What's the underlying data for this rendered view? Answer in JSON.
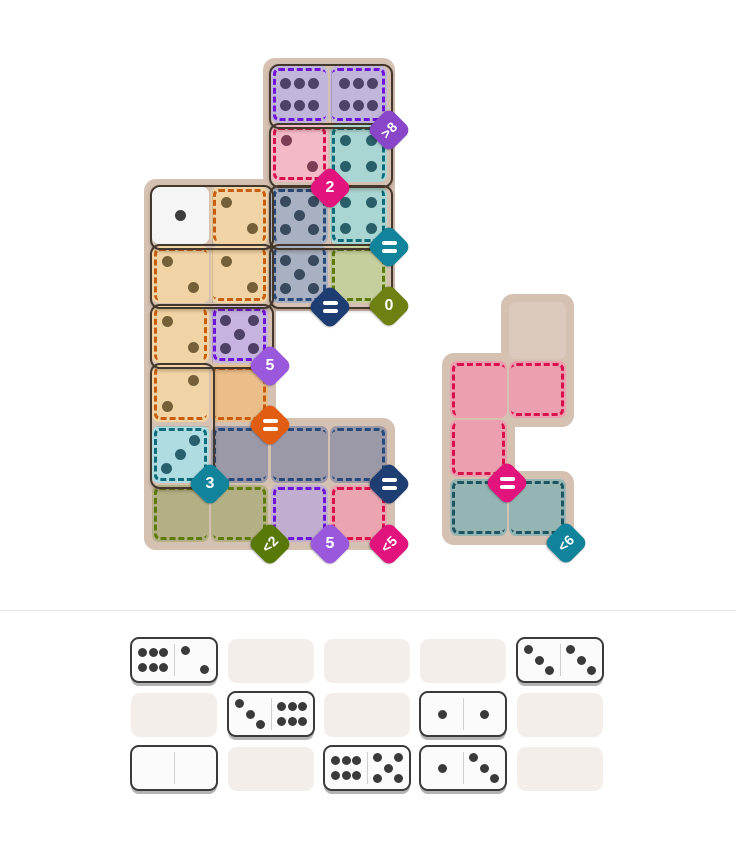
{
  "app": {
    "name": "domino-regions-puzzle"
  },
  "palette": {
    "page_bg": "#ffffff",
    "divider": "#e4e4e4",
    "backdrop": "#d5c1b2",
    "pair_outline": "#44372c",
    "tray_slot": "#f4eeea",
    "tray_tile_face": "#fbfbfb",
    "tray_tile_border": "#3a3a3a",
    "tray_tile_shadow": "#b3b3b3",
    "tray_pip": "#3a3a3a",
    "fills": {
      "purple_f": "#c1b5da",
      "pink_f": "#f3b9c7",
      "teal_f": "#a9d6d2",
      "slate_f": "#a7b1c1",
      "white_f": "#f5f5f6",
      "orange_f": "#f1d4a5",
      "violet_f": "#c7b3e0",
      "cyan_f": "#afdce1",
      "olive_f": "#c5cf9e",
      "orange_u": "#eabd89",
      "gray_u": "#9b99a7",
      "olive_u": "#b3b085",
      "purple_u": "#c0add0",
      "pink_u": "#eaa5b1",
      "side_pink_u": "#ec9fae",
      "side_teal_u": "#94b5b4",
      "side_tan": "#dcc9bd"
    },
    "pips": {
      "purple": "#4e4266",
      "pink": "#7c3e56",
      "teal": "#295f68",
      "slate": "#394a5f",
      "white": "#3d3d3d",
      "orange": "#75603a",
      "violet": "#4e4066",
      "cyan": "#2a606e"
    },
    "dashes": {
      "purple": "#6d14d8",
      "crimson": "#d8104c",
      "teal": "#0d6b7a",
      "navy": "#27497c",
      "orange": "#c85d0e",
      "olive": "#5d7a0a",
      "side_teal": "#1d545f"
    },
    "badges": {
      "purple": "#8a46c9",
      "lpurple": "#9a58dd",
      "magenta": "#e2137c",
      "teal": "#11839a",
      "navy": "#1e3d72",
      "olive": "#6d8011",
      "olive_dark": "#587907",
      "orange": "#e15d11"
    }
  },
  "board": {
    "cells": [
      {
        "id": "C1",
        "col": 2,
        "row": 0,
        "fill": "purple_f",
        "pips": 6,
        "pip_color": "purple",
        "dash": "purple",
        "sides": "TLB"
      },
      {
        "id": "D1",
        "col": 3,
        "row": 0,
        "fill": "purple_f",
        "pips": 6,
        "pip_color": "purple",
        "dash": "purple",
        "sides": "TRB"
      },
      {
        "id": "C2",
        "col": 2,
        "row": 1,
        "fill": "pink_f",
        "pips": 2,
        "pip_color": "pink",
        "dash": "crimson",
        "sides": "TLRB"
      },
      {
        "id": "D2",
        "col": 3,
        "row": 1,
        "fill": "teal_f",
        "pips": 4,
        "pip_color": "teal",
        "dash": "teal",
        "sides": "TLR"
      },
      {
        "id": "A3",
        "col": 0,
        "row": 2,
        "fill": "white_f",
        "pips": 1,
        "pip_color": "white"
      },
      {
        "id": "B3",
        "col": 1,
        "row": 2,
        "fill": "orange_f",
        "pips": 2,
        "pip_color": "orange",
        "dash": "orange",
        "sides": "TLR"
      },
      {
        "id": "C3",
        "col": 2,
        "row": 2,
        "fill": "slate_f",
        "pips": 5,
        "pip_color": "slate",
        "dash": "navy",
        "sides": "TLR"
      },
      {
        "id": "D3",
        "col": 3,
        "row": 2,
        "fill": "teal_f",
        "pips": 4,
        "pip_color": "teal",
        "dash": "teal",
        "sides": "LRB"
      },
      {
        "id": "A4",
        "col": 0,
        "row": 3,
        "fill": "orange_f",
        "pips": 2,
        "pip_color": "orange",
        "dash": "orange",
        "sides": "TL"
      },
      {
        "id": "B4",
        "col": 1,
        "row": 3,
        "fill": "orange_f",
        "pips": 2,
        "pip_color": "orange",
        "dash": "orange",
        "sides": "RB"
      },
      {
        "id": "C4",
        "col": 2,
        "row": 3,
        "fill": "slate_f",
        "pips": 5,
        "pip_color": "slate",
        "dash": "navy",
        "sides": "LRB"
      },
      {
        "id": "D4",
        "col": 3,
        "row": 3,
        "fill": "olive_f",
        "pips": 0,
        "dash": "olive",
        "sides": "TLRB"
      },
      {
        "id": "A5",
        "col": 0,
        "row": 4,
        "fill": "orange_f",
        "pips": 2,
        "pip_color": "orange",
        "dash": "orange",
        "sides": "LR"
      },
      {
        "id": "B5",
        "col": 1,
        "row": 4,
        "fill": "violet_f",
        "pips": 5,
        "pip_color": "violet",
        "dash": "purple",
        "sides": "TLRB"
      },
      {
        "id": "A6",
        "col": 0,
        "row": 5,
        "fill": "orange_f",
        "pips": 2,
        "variant": "2r",
        "pip_color": "orange",
        "dash": "orange",
        "sides": "LB"
      },
      {
        "id": "B6",
        "col": 1,
        "row": 5,
        "fill": "orange_u",
        "pips": 0,
        "dash": "orange",
        "sides": "TRB"
      },
      {
        "id": "A7",
        "col": 0,
        "row": 6,
        "fill": "cyan_f",
        "pips": 3,
        "variant": "3r",
        "pip_color": "cyan",
        "dash": "teal",
        "sides": "TLRB"
      },
      {
        "id": "B7",
        "col": 1,
        "row": 6,
        "fill": "gray_u",
        "pips": 0,
        "dash": "navy",
        "sides": "TLB"
      },
      {
        "id": "C7",
        "col": 2,
        "row": 6,
        "fill": "gray_u",
        "pips": 0,
        "dash": "navy",
        "sides": "TB"
      },
      {
        "id": "D7",
        "col": 3,
        "row": 6,
        "fill": "gray_u",
        "pips": 0,
        "dash": "navy",
        "sides": "TRB"
      },
      {
        "id": "A8",
        "col": 0,
        "row": 7,
        "fill": "olive_u",
        "pips": 0,
        "dash": "olive",
        "sides": "TLB"
      },
      {
        "id": "B8",
        "col": 1,
        "row": 7,
        "fill": "olive_u",
        "pips": 0,
        "dash": "olive",
        "sides": "TRB"
      },
      {
        "id": "C8",
        "col": 2,
        "row": 7,
        "fill": "purple_u",
        "pips": 0,
        "dash": "purple",
        "sides": "TLRB"
      },
      {
        "id": "D8",
        "col": 3,
        "row": 7,
        "fill": "pink_u",
        "pips": 0,
        "dash": "crimson",
        "sides": "TLRB"
      }
    ],
    "pairs": [
      {
        "cells": [
          "C1",
          "D1"
        ],
        "value": "6|6"
      },
      {
        "cells": [
          "C2",
          "D2"
        ],
        "value": "2|4"
      },
      {
        "cells": [
          "C3",
          "D3"
        ],
        "value": "5|4"
      },
      {
        "cells": [
          "C4",
          "D4"
        ],
        "value": "5|0"
      },
      {
        "cells": [
          "A3",
          "B3"
        ],
        "value": "1|2"
      },
      {
        "cells": [
          "A4",
          "B4"
        ],
        "value": "2|2"
      },
      {
        "cells": [
          "A5",
          "B5"
        ],
        "value": "2|5"
      },
      {
        "cells": [
          "A6",
          "A7"
        ],
        "value": "2|3"
      }
    ],
    "badges": [
      {
        "label": ">8",
        "color": "purple",
        "x": 389,
        "y": 130
      },
      {
        "label": "2",
        "color": "magenta",
        "x": 330,
        "y": 188
      },
      {
        "label": "=",
        "color": "teal",
        "x": 389,
        "y": 247
      },
      {
        "label": "=",
        "color": "navy",
        "x": 330,
        "y": 307
      },
      {
        "label": "0",
        "color": "olive",
        "x": 389,
        "y": 306
      },
      {
        "label": "5",
        "color": "lpurple",
        "x": 270,
        "y": 366
      },
      {
        "label": "=",
        "color": "orange",
        "x": 270,
        "y": 425
      },
      {
        "label": "3",
        "color": "teal",
        "x": 210,
        "y": 484
      },
      {
        "label": "=",
        "color": "navy",
        "x": 389,
        "y": 484
      },
      {
        "label": "<2",
        "color": "olive_dark",
        "x": 270,
        "y": 544
      },
      {
        "label": "5",
        "color": "lpurple",
        "x": 330,
        "y": 544
      },
      {
        "label": "<5",
        "color": "magenta",
        "x": 389,
        "y": 544
      }
    ]
  },
  "side_piece": {
    "cells": [
      {
        "id": "S1",
        "col": 1,
        "row": 0,
        "fill": "side_tan",
        "pips": 0
      },
      {
        "id": "P1",
        "col": 0,
        "row": 1,
        "fill": "side_pink_u",
        "pips": 0,
        "dash": "crimson",
        "sides": "TL"
      },
      {
        "id": "P2",
        "col": 1,
        "row": 1,
        "fill": "side_pink_u",
        "pips": 0,
        "dash": "crimson",
        "sides": "TRB"
      },
      {
        "id": "P3",
        "col": 0,
        "row": 2,
        "fill": "side_pink_u",
        "pips": 0,
        "dash": "crimson",
        "sides": "LRB"
      },
      {
        "id": "T1",
        "col": 0,
        "row": 3,
        "fill": "side_teal_u",
        "pips": 0,
        "dash": "side_teal",
        "sides": "TLB"
      },
      {
        "id": "T2",
        "col": 1,
        "row": 3,
        "fill": "side_teal_u",
        "pips": 0,
        "dash": "side_teal",
        "sides": "TRB"
      }
    ],
    "badges": [
      {
        "label": "=",
        "color": "magenta",
        "x": 507,
        "y": 483
      },
      {
        "label": "<6",
        "color": "teal",
        "x": 566,
        "y": 543
      }
    ]
  },
  "tray": {
    "rows": 3,
    "cols": 5,
    "dominoes": [
      {
        "row": 0,
        "col": 0,
        "left": 6,
        "right": 2,
        "label": "6|2"
      },
      {
        "row": 0,
        "col": 4,
        "left": 3,
        "right": 3,
        "label": "3|3"
      },
      {
        "row": 1,
        "col": 1,
        "left": 3,
        "right": 6,
        "label": "3|6"
      },
      {
        "row": 1,
        "col": 3,
        "left": 1,
        "right": 1,
        "label": "1|1"
      },
      {
        "row": 2,
        "col": 0,
        "left": 0,
        "right": 0,
        "label": "0|0"
      },
      {
        "row": 2,
        "col": 2,
        "left": 6,
        "right": 5,
        "label": "6|5"
      },
      {
        "row": 2,
        "col": 3,
        "left": 1,
        "right": 3,
        "label": "1|3"
      }
    ]
  }
}
